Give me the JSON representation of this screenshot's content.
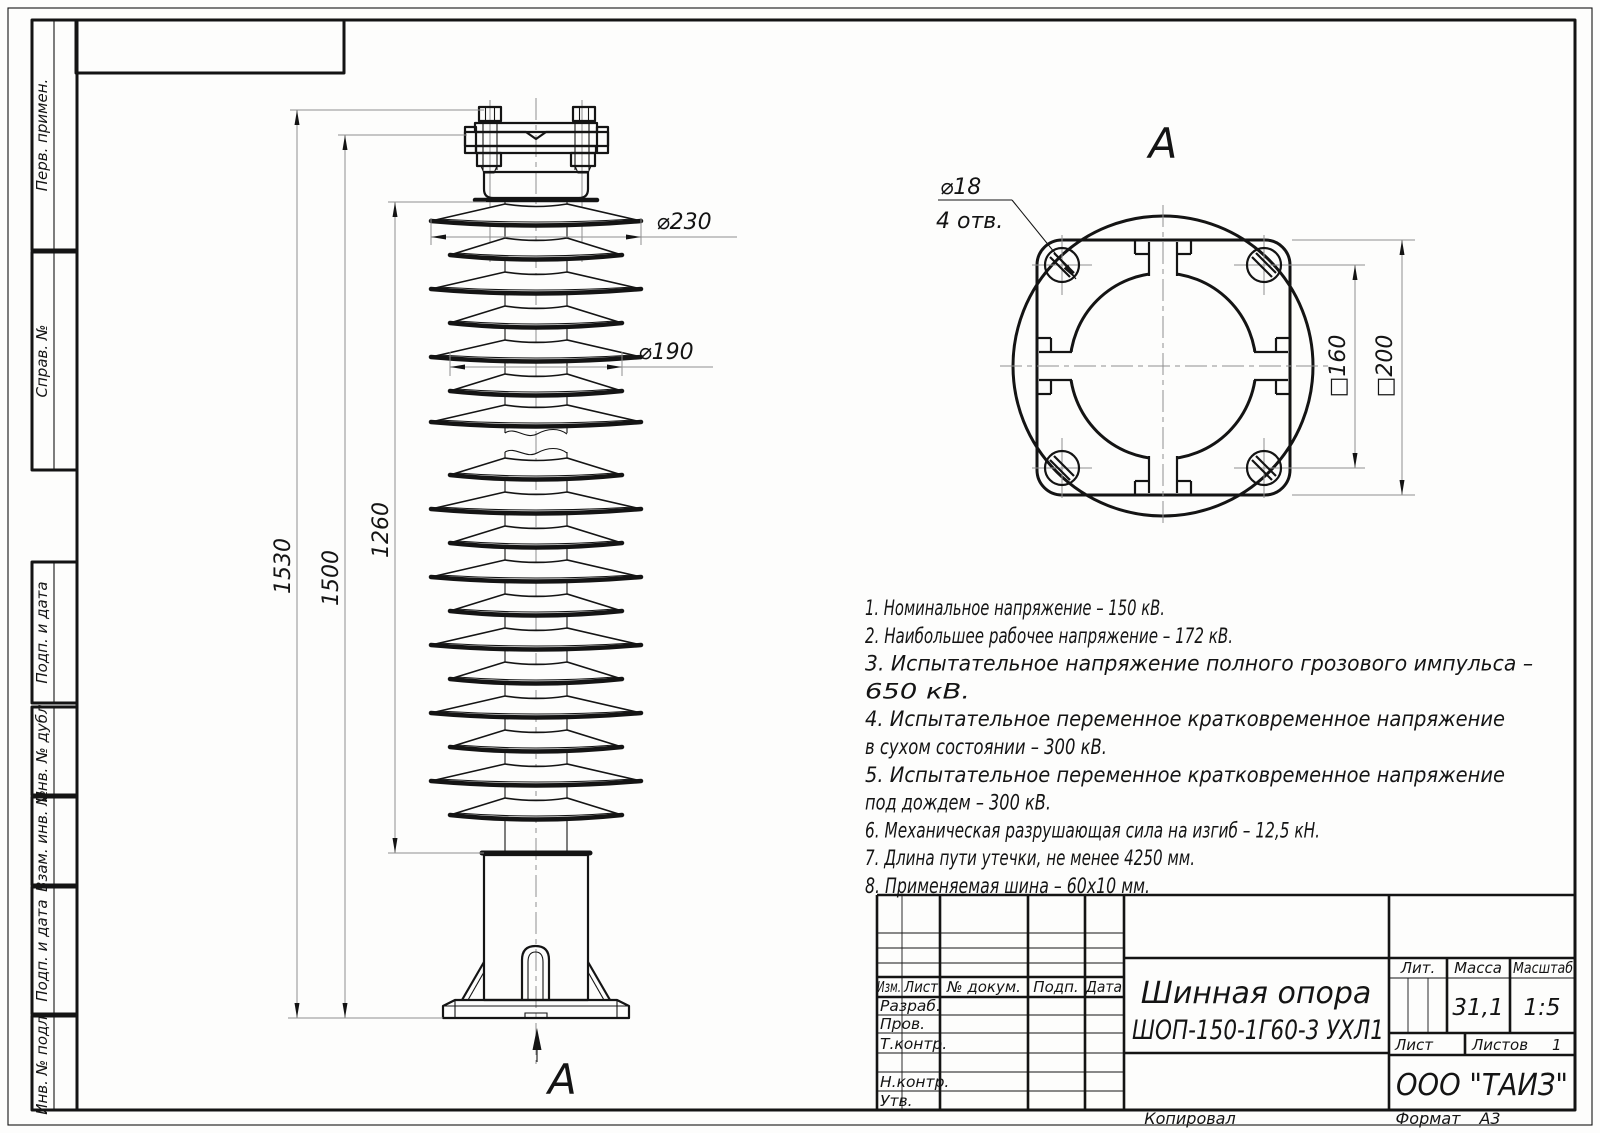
{
  "margin_strips": [
    "Перв. примен.",
    "Справ. №",
    "Подп. и дата",
    "Инв. № дубл.",
    "Взам. инв. №",
    "Подп. и дата",
    "Инв. № подл."
  ],
  "main_view": {
    "dim_height_overall": "1530",
    "dim_height_1500": "1500",
    "dim_height_1260": "1260",
    "dim_dia_230": "⌀230",
    "dim_dia_190": "⌀190",
    "view_arrow_label": "А"
  },
  "view_a": {
    "label": "А",
    "holes_dia": "⌀18",
    "holes_count": "4 отв.",
    "dim_square_160": "□160",
    "dim_square_200": "□200"
  },
  "tech_requirements": [
    "1. Номинальное напряжение – 150 кВ.",
    "2. Наибольшее рабочее напряжение – 172 кВ.",
    "3. Испытательное напряжение полного грозового импульса –",
    "650 кВ.",
    "4. Испытательное переменное кратковременное напряжение",
    "в сухом состоянии – 300 кВ.",
    "5. Испытательное переменное кратковременное напряжение",
    "под дождем – 300 кВ.",
    "6. Механическая разрушающая сила на изгиб – 12,5 кН.",
    "7. Длина пути утечки, не менее 4250 мм.",
    "8. Применяемая шина – 60х10 мм."
  ],
  "title_block": {
    "col_izm": "Изм.",
    "col_list": "Лист",
    "col_doc": "№ докум.",
    "col_podp": "Подп.",
    "col_data": "Дата",
    "row_razrab": "Разраб.",
    "row_prov": "Пров.",
    "row_tkontr": "Т.контр.",
    "row_nkontr": "Н.контр.",
    "row_utv": "Утв.",
    "title_line1": "Шинная опора",
    "title_line2": "ШОП-150-1Г60-3 УХЛ1",
    "lit_label": "Лит.",
    "mass_label": "Масса",
    "scale_label": "Масштаб",
    "mass_value": "31,1",
    "scale_value": "1:5",
    "sheet_label": "Лист",
    "sheets_label": "Листов",
    "sheets_value": "1",
    "company": "ООО \"ТАИЗ\""
  },
  "sheet_footer": {
    "copied": "Копировал",
    "format_label": "Формат",
    "format_value": "А3"
  }
}
